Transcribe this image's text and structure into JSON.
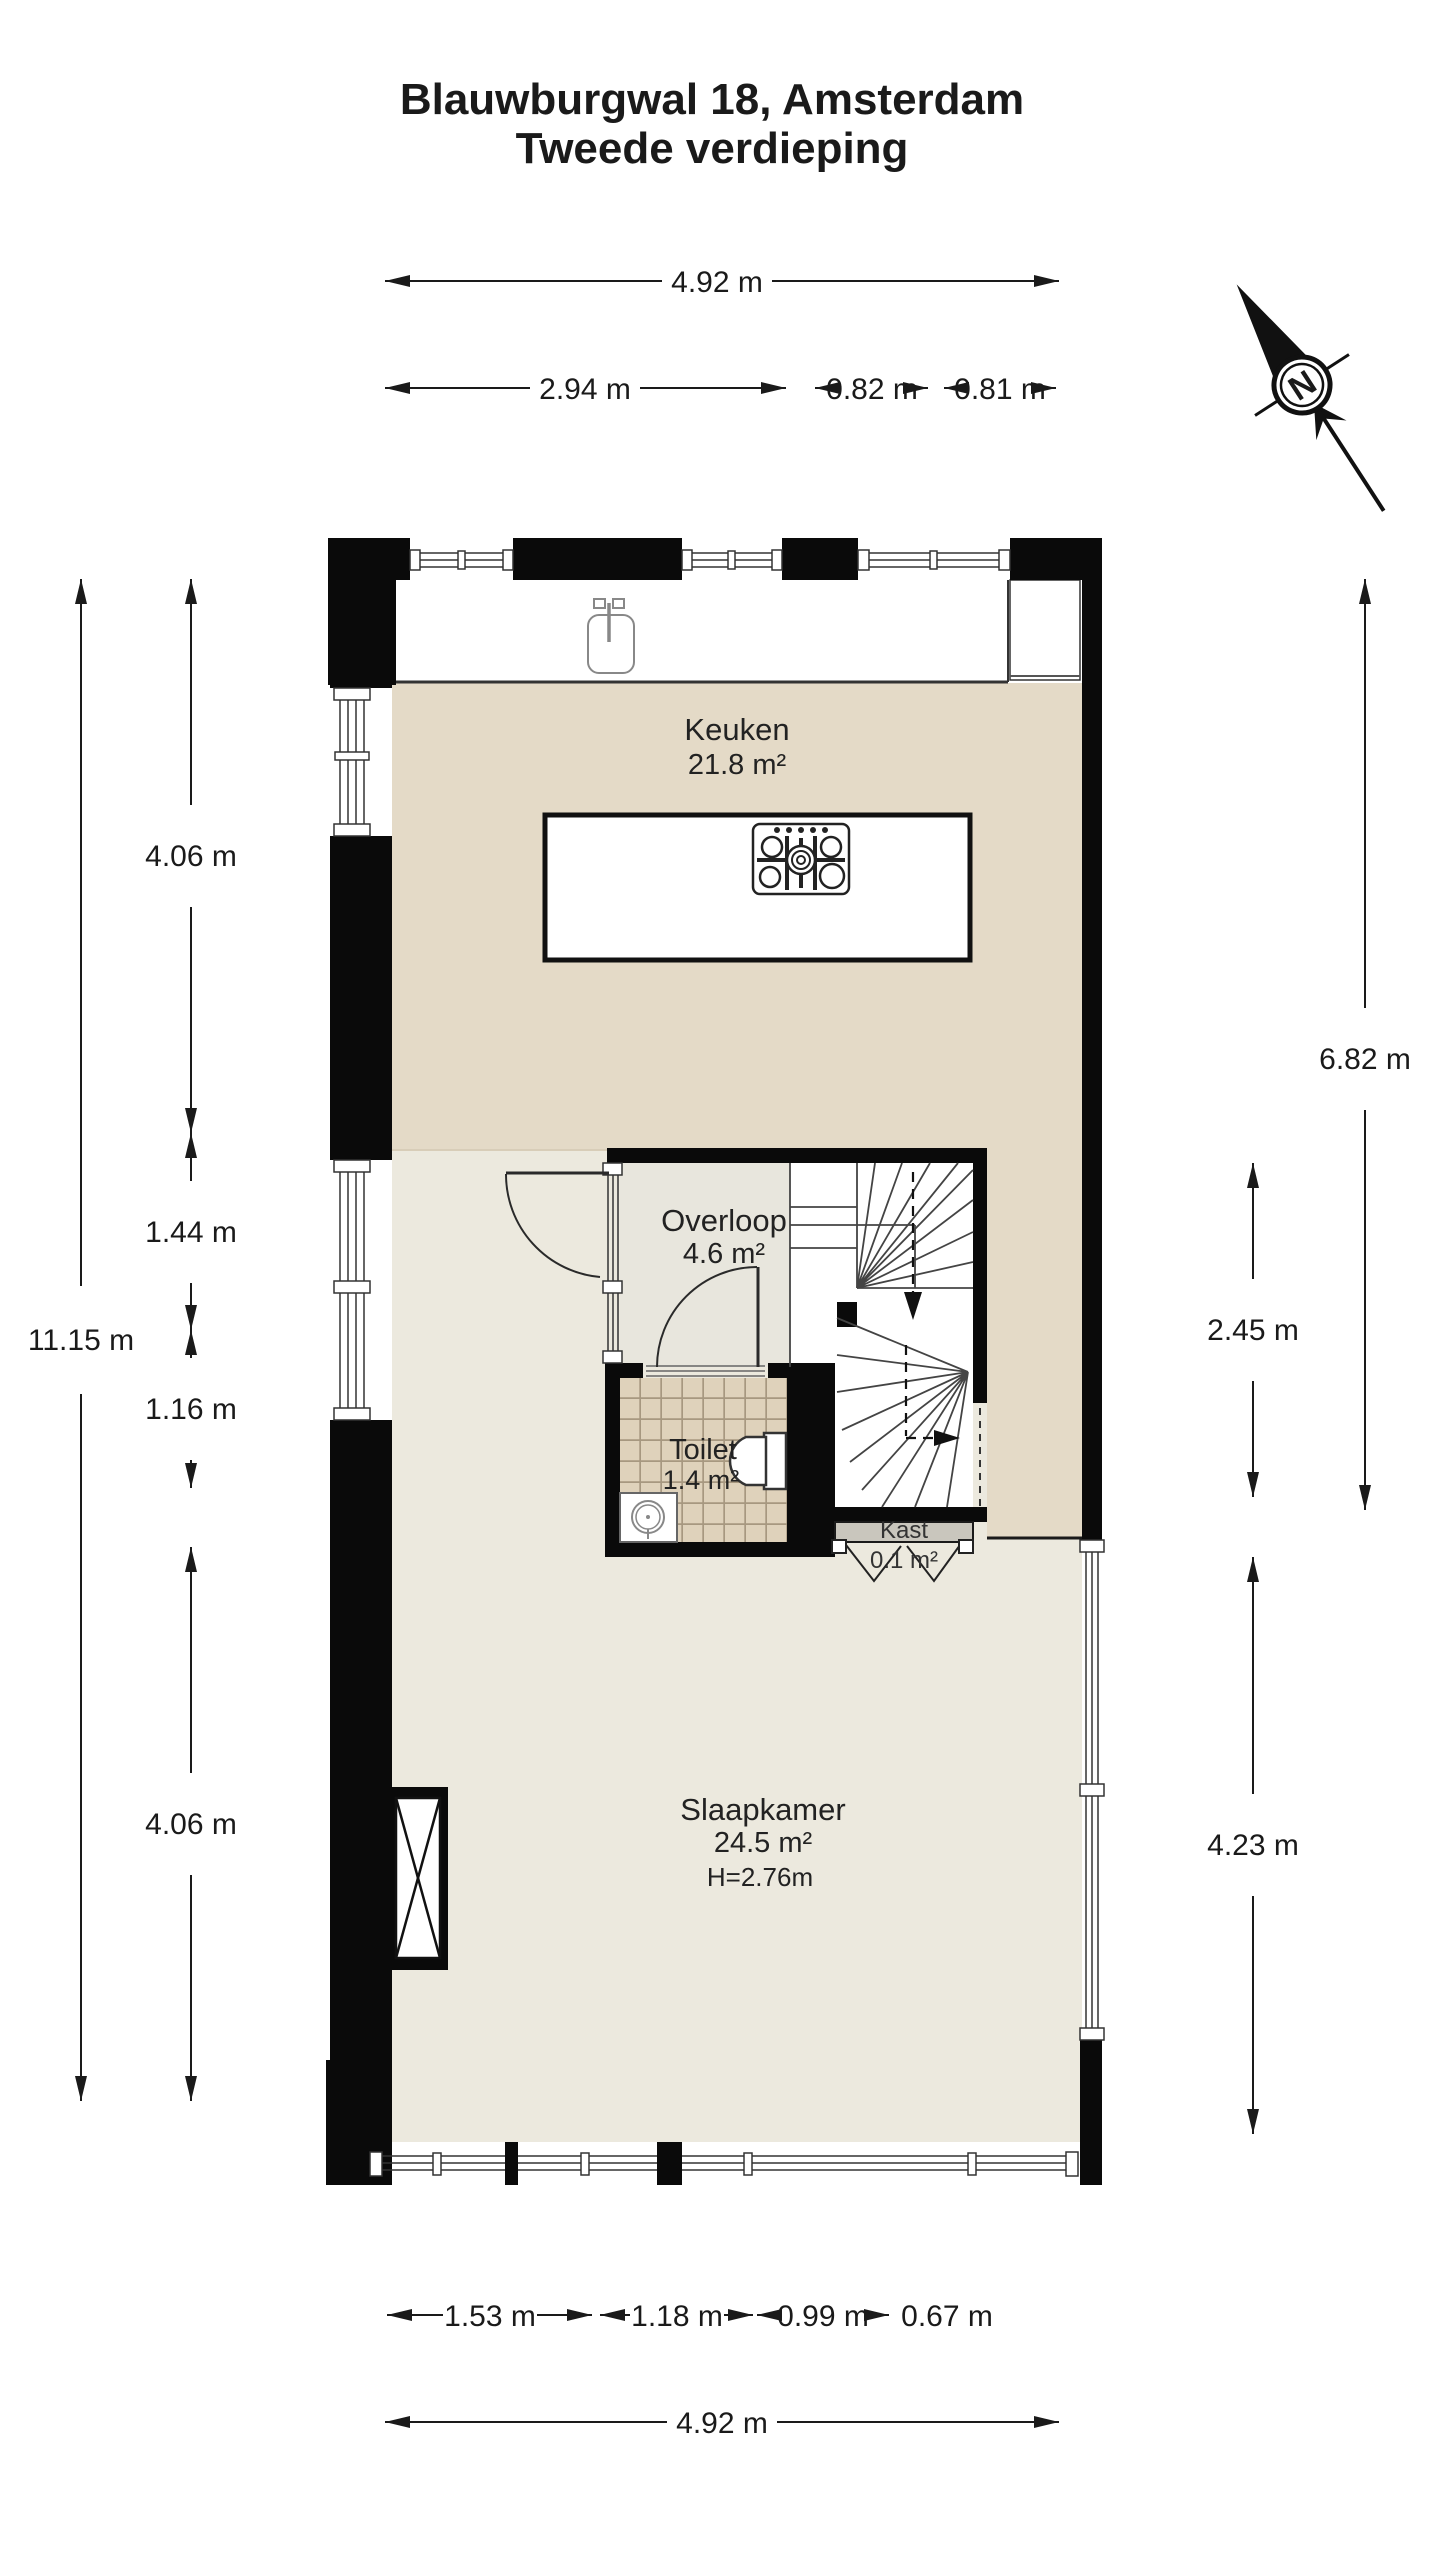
{
  "title": {
    "line1": "Blauwburgwal 18, Amsterdam",
    "line2": "Tweede verdieping"
  },
  "compass": {
    "label": "N"
  },
  "rooms": {
    "keuken": {
      "name": "Keuken",
      "area": "21.8 m²"
    },
    "overloop": {
      "name": "Overloop",
      "area": "4.6 m²"
    },
    "toilet": {
      "name": "Toilet",
      "area": "1.4 m²"
    },
    "kast": {
      "name": "Kast",
      "area": "0.1 m²"
    },
    "slaapkamer": {
      "name": "Slaapkamer",
      "area": "24.5 m²",
      "ceiling_height": "H=2.76m"
    }
  },
  "dimensions": {
    "top_total": "4.92 m",
    "top_left": "2.94 m",
    "top_mid": "0.82 m",
    "top_right": "0.81 m",
    "left_total": "11.15 m",
    "left_keuken": "4.06 m",
    "left_overloop": "1.44 m",
    "left_toilet": "1.16 m",
    "left_slaapkamer": "4.06 m",
    "right_upper": "6.82 m",
    "right_stairs": "2.45 m",
    "right_slaapkamer": "4.23 m",
    "bottom_w1": "1.53 m",
    "bottom_w2": "1.18 m",
    "bottom_w3": "0.99 m",
    "bottom_w4": "0.67 m",
    "bottom_total": "4.92 m"
  },
  "colors": {
    "wall": "#0a0a0a",
    "floor_keuken": "#e4dac7",
    "floor_slaapkamer": "#ece9de",
    "floor_overloop": "#e8e6dd",
    "toilet_tile": "#dfd2bb",
    "toilet_grout": "#a79880",
    "kast_fill": "#c9c6bd",
    "dimension_line": "#1a1a1a"
  }
}
